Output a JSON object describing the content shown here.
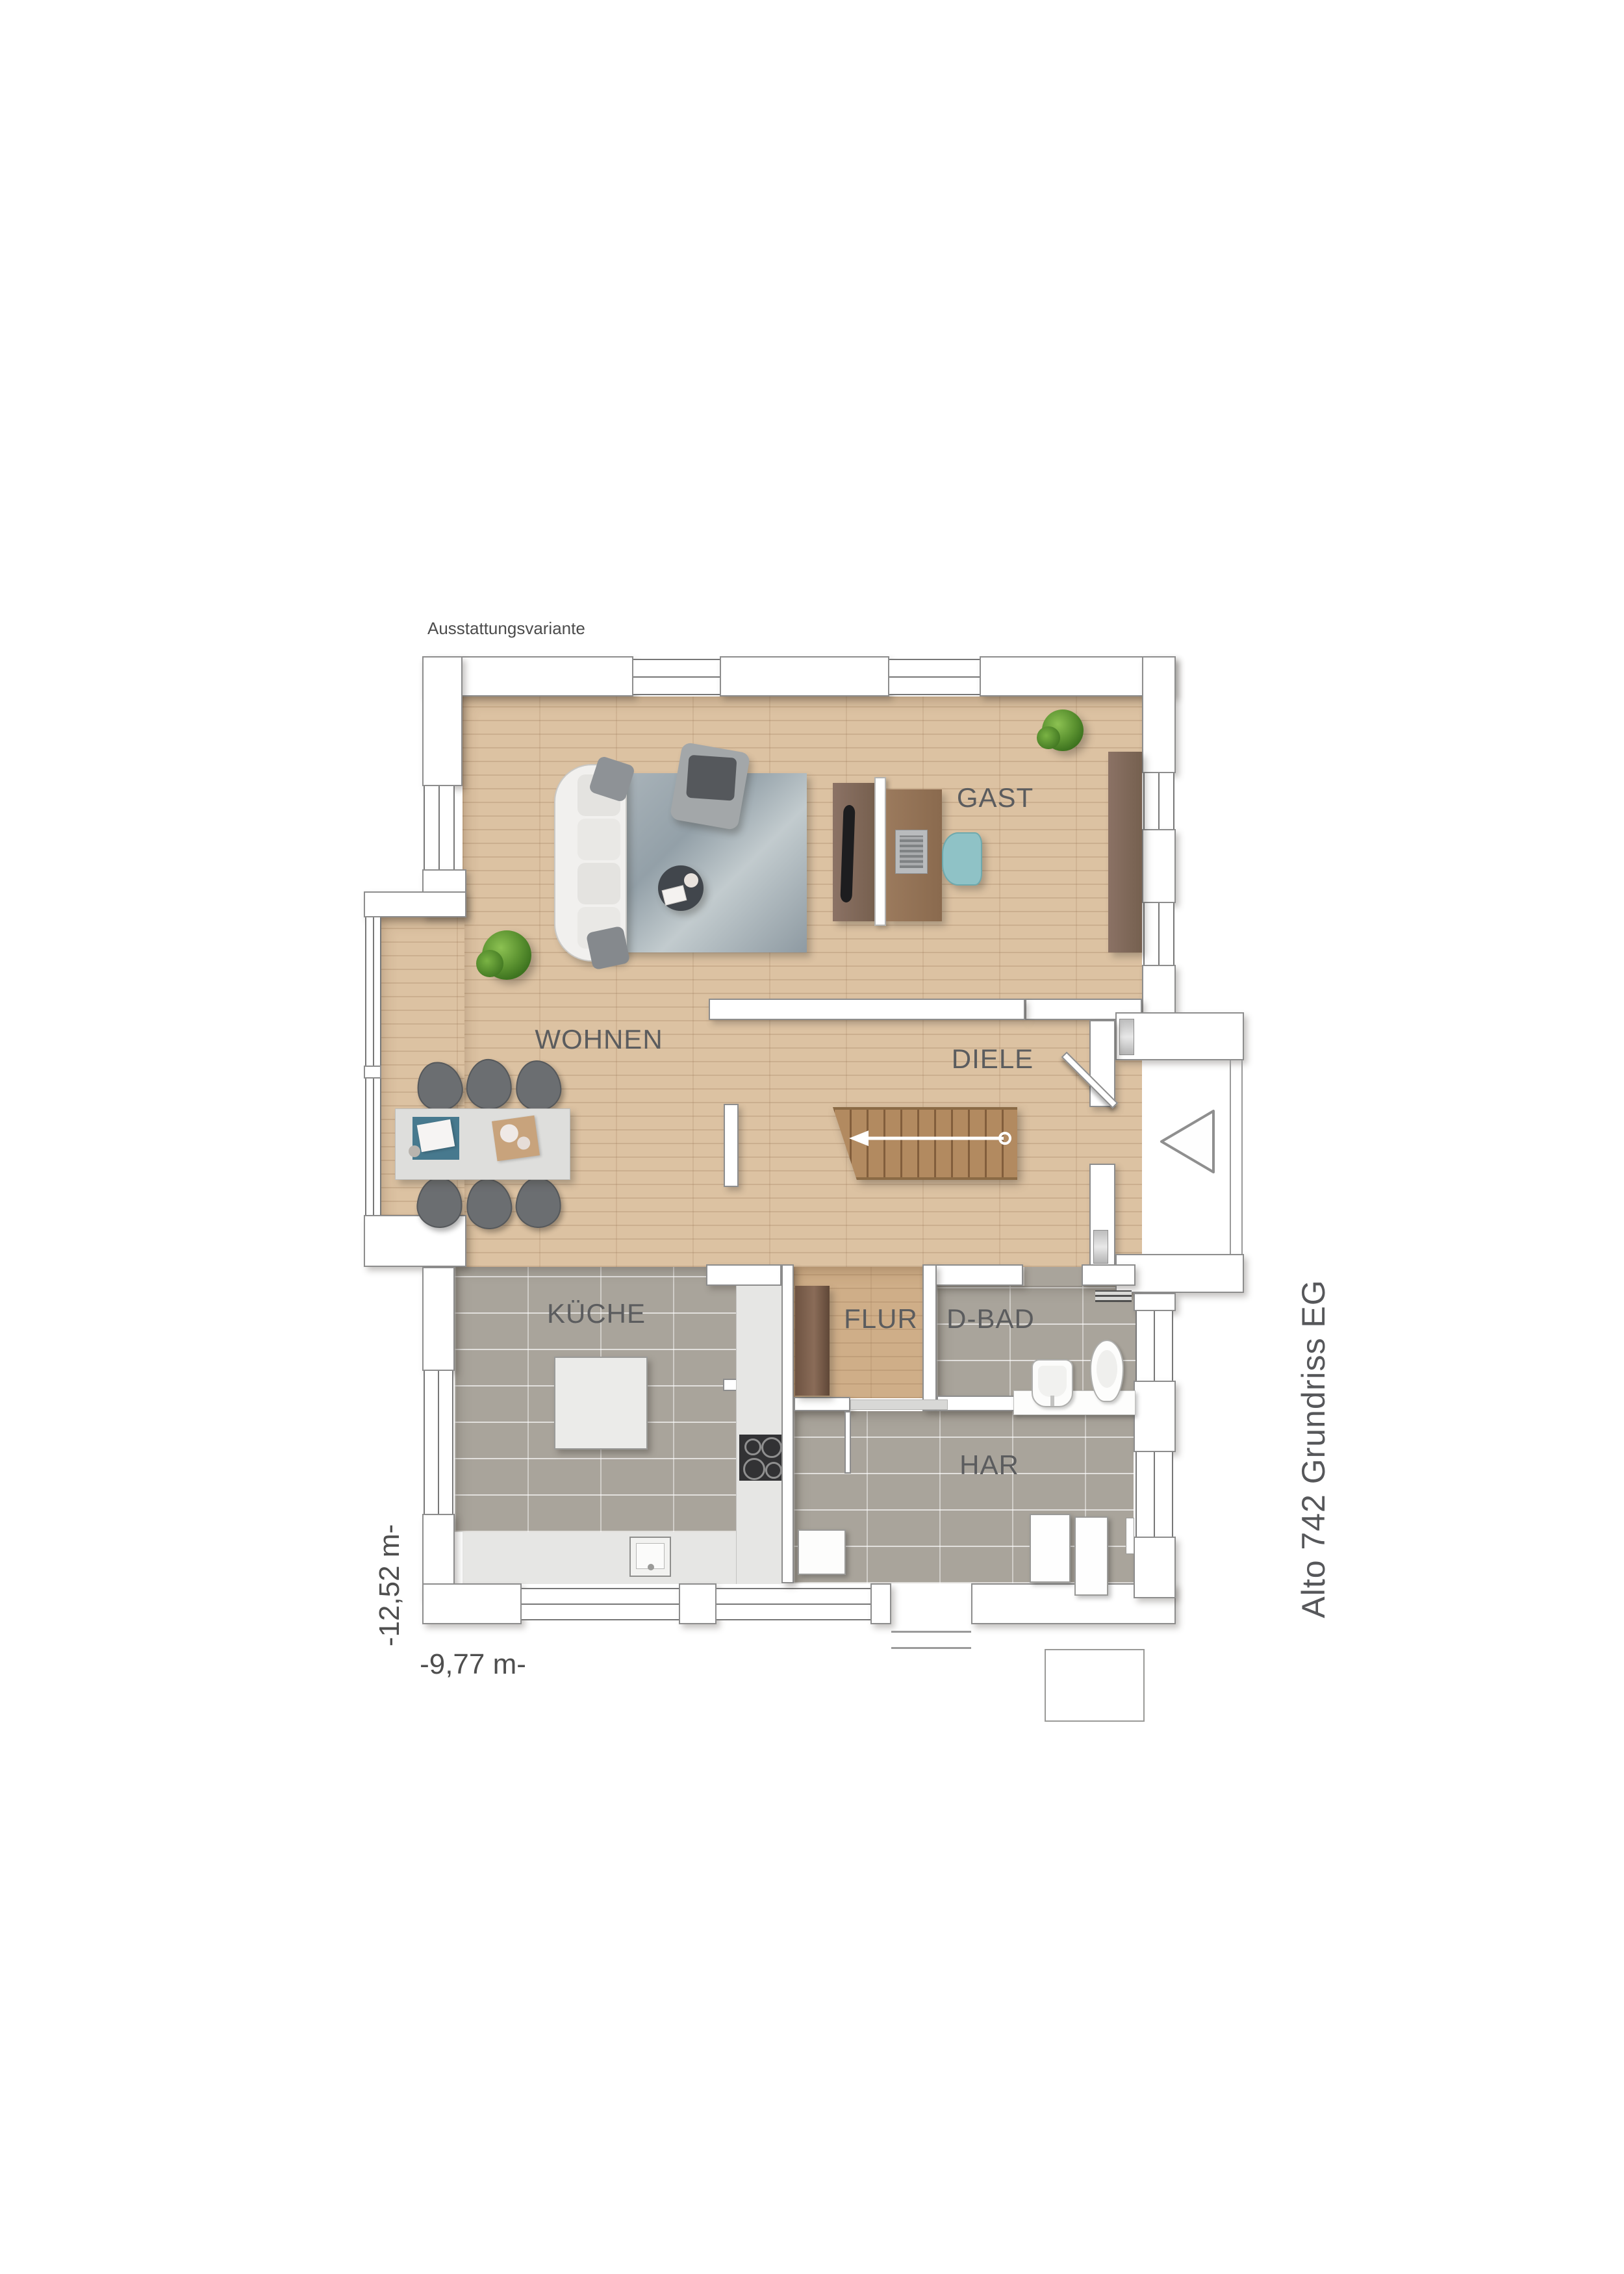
{
  "annotations": {
    "variant_label": "Ausstattungsvariante",
    "plan_title": "Alto 742 Grundriss EG",
    "dimension_width": "-9,77 m-",
    "dimension_depth": "-12,52 m-"
  },
  "rooms": [
    {
      "id": "wohnen",
      "name": "WOHNEN"
    },
    {
      "id": "gast",
      "name": "GAST"
    },
    {
      "id": "diele",
      "name": "DIELE"
    },
    {
      "id": "kueche",
      "name": "KÜCHE"
    },
    {
      "id": "flur",
      "name": "FLUR"
    },
    {
      "id": "d-bad",
      "name": "D-BAD"
    },
    {
      "id": "har",
      "name": "HAR"
    }
  ],
  "furniture": {
    "wohnen": [
      "sofa",
      "rug",
      "coffee-table",
      "armchair",
      "plant",
      "dining-table",
      "dining-chairs"
    ],
    "gast": [
      "tv-sideboard",
      "room-divider",
      "desk",
      "laptop",
      "desk-chair",
      "wardrobe",
      "plant"
    ],
    "diele": [
      "staircase",
      "front-door"
    ],
    "kueche": [
      "island",
      "counter",
      "cooktop",
      "sink"
    ],
    "flur": [
      "wardrobe"
    ],
    "d-bad": [
      "washbasin",
      "toilet",
      "vanity",
      "towel-radiator"
    ],
    "har": [
      "washing-machine",
      "dryer",
      "appliance-box"
    ]
  },
  "colors": {
    "wood_floor": "#dcc2a2",
    "tile_floor": "#a9a49b",
    "wall_fill": "#ffffff",
    "wall_outline": "#8d8d8d",
    "label_text": "#5b5c5e",
    "furniture_wood_dark": "#7c604f",
    "furniture_wood_mid": "#8b7265",
    "stair_wood": "#b28a60",
    "accent_teal_chair": "#8fc2c6",
    "accent_teal_mat": "#47798e",
    "rug_grey": "#9fa9b0",
    "plant_green": "#5c9331"
  }
}
